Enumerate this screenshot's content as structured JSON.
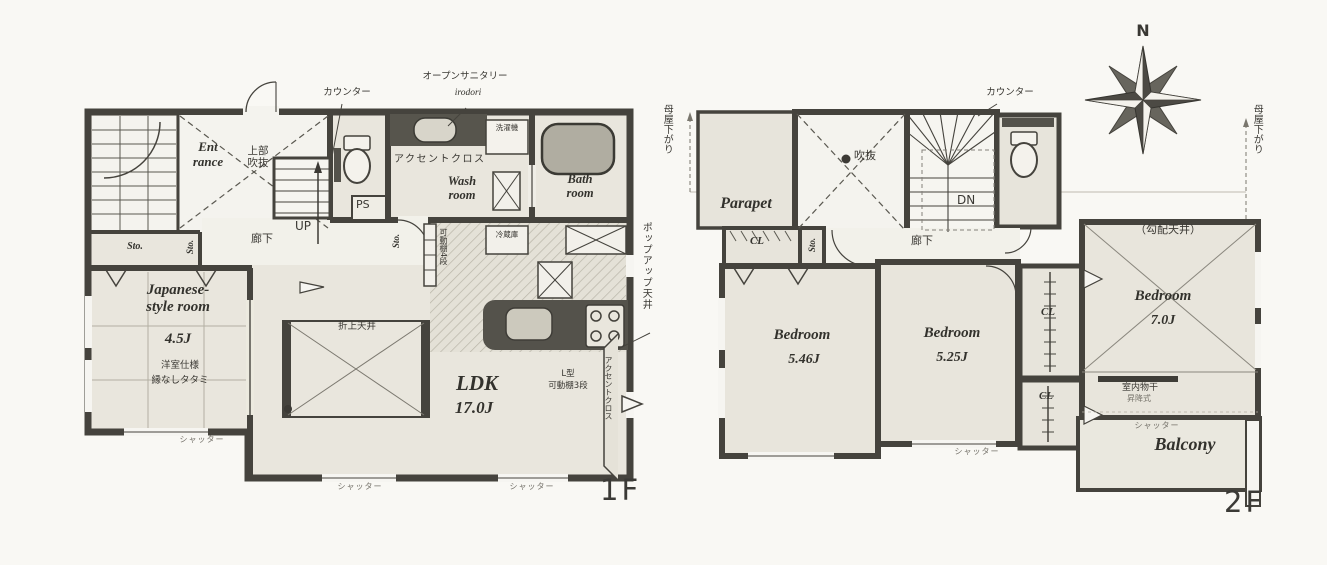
{
  "f1": {
    "floor_label": "1F",
    "counter_label": "カウンター",
    "open_sanitary": "オープンサニタリー",
    "open_sanitary_sub": "irodori",
    "entrance": "Ent\nrance",
    "upper_void": "上部\n吹抜",
    "up": "UP",
    "hallway": "廊下",
    "ps": "PS",
    "sto": "Sto.",
    "accent_cloth": "アクセントクロス",
    "washroom": "Wash\nroom",
    "washer": "洗濯機",
    "bathroom": "Bath\nroom",
    "fridge": "冷蔵庫",
    "japanese_room": "Japanese-\nstyle room",
    "japanese_room_size": "4.5J",
    "tatami_note1": "洋室仕様",
    "tatami_note2": "縁なしタタミ",
    "ldk": "LDK",
    "ldk_size": "17.0J",
    "coffered_ceiling": "折上天井",
    "popup_ceiling": "ポップアップ天井",
    "l_shelf_line1": "L型",
    "l_shelf_line2": "可動棚3段",
    "pantry_shelf": "可動棚4段",
    "shutter": "シャッター"
  },
  "f2": {
    "floor_label": "2F",
    "moya_sagari": "母屋下がり",
    "parapet": "Parapet",
    "void": "吹抜",
    "dn": "DN",
    "counter_label": "カウンター",
    "hallway": "廊下",
    "cl": "CL",
    "sto": "Sto.",
    "bedroom": "Bedroom",
    "bedroom1_size": "5.46J",
    "bedroom2_size": "5.25J",
    "bedroom3_size": "7.0J",
    "sloped_ceiling": "（勾配天井）",
    "indoor_drying": "室内物干",
    "indoor_drying_type": "昇降式",
    "balcony": "Balcony",
    "shutter": "シャッター"
  },
  "compass": {
    "north": "N"
  },
  "colors": {
    "wall": "#45433d",
    "room_fill": "#e8e5dc",
    "paper": "#f9f8f4",
    "counter_dark": "#54524b"
  }
}
